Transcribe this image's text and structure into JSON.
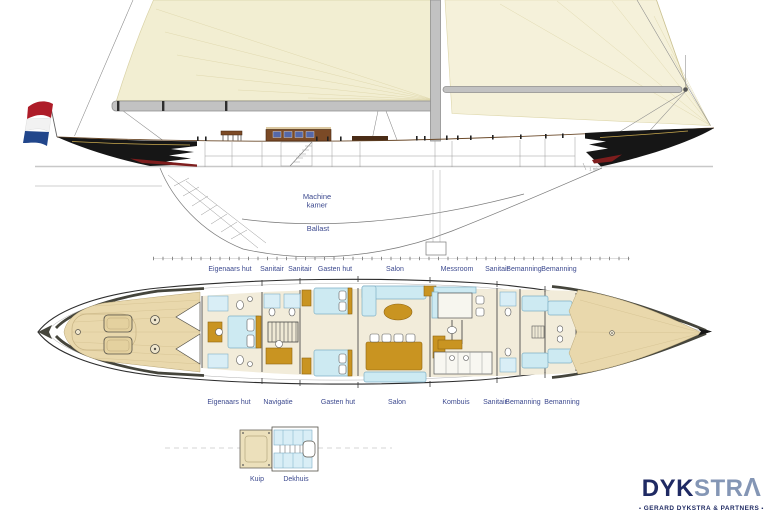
{
  "drawing": {
    "profile_labels": {
      "machine_kamer_line1": "Machine",
      "machine_kamer_line2": "kamer",
      "ballast": "Ballast",
      "waterline_mark": "1 mtr"
    },
    "plan_labels_upper": [
      "Eigenaars hut",
      "Sanitair",
      "Sanitair",
      "Gasten hut",
      "Salon",
      "Messroom",
      "Sanitair",
      "Bemanning",
      "Bemanning"
    ],
    "plan_labels_lower": [
      "Eigenaars hut",
      "Navigatie",
      "Gasten hut",
      "Salon",
      "Kombuis",
      "Sanitair",
      "Bemanning",
      "Bemanning"
    ],
    "section_labels": {
      "kuip": "Kuip",
      "dekhuis": "Dekhuis"
    }
  },
  "logo": {
    "name_dark": "DYK",
    "name_light": "STR",
    "name_final": "Λ",
    "tagline": "GERARD DYKSTRA & PARTNERS",
    "tagline_mark": "▪"
  },
  "colors": {
    "sail": "#f2eed2",
    "sail2": "#f5f1da",
    "sailline": "#ddd5a8",
    "spar": "#c2c2c2",
    "sparedge": "#8f8f8f",
    "hull": "#161616",
    "rednav": "#7e1d1d",
    "flagred": "#ae1c28",
    "flagwhite": "#f2f2f2",
    "flagblue": "#21468b",
    "waterline": "#c8c8c8",
    "teak": "#e9d8ac",
    "teakline": "#d5c292",
    "floor": "#f2ecda",
    "bed": "#cdeaf2",
    "bededge": "#7fb0c6",
    "wood": "#c99421",
    "woodedge": "#8f6410",
    "outline": "#2e2e2e",
    "caprail": "#45453c",
    "windowblue": "#5668a8",
    "labelblue": "#3d4a8f",
    "logonavy": "#1f2a63",
    "logosteel": "#8496b5"
  }
}
